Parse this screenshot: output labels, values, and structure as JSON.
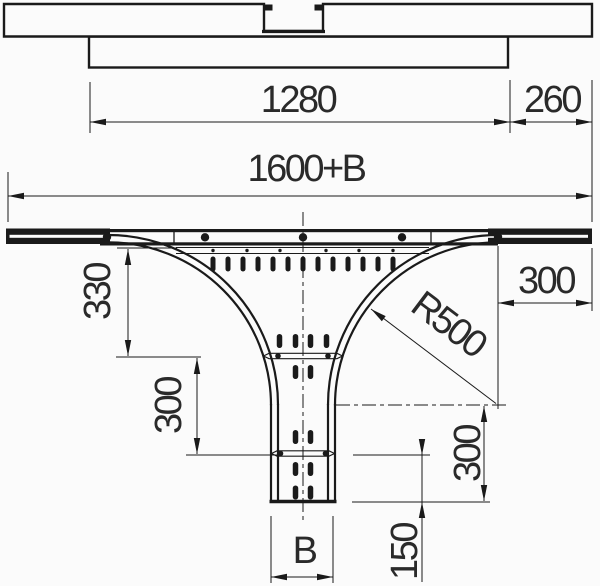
{
  "labels": {
    "top_length_inner": "1280",
    "top_length_end": "260",
    "total_length": "1600+B",
    "branch_offset": "330",
    "branch_mid_section": "300",
    "radius": "R500",
    "side_run_length": "300",
    "branch_lower_section": "300",
    "branch_end_section": "150",
    "branch_width": "B"
  },
  "colors": {
    "line": "#1a1a1a",
    "text": "#2a2a2a",
    "background": "#fbfbfb"
  }
}
